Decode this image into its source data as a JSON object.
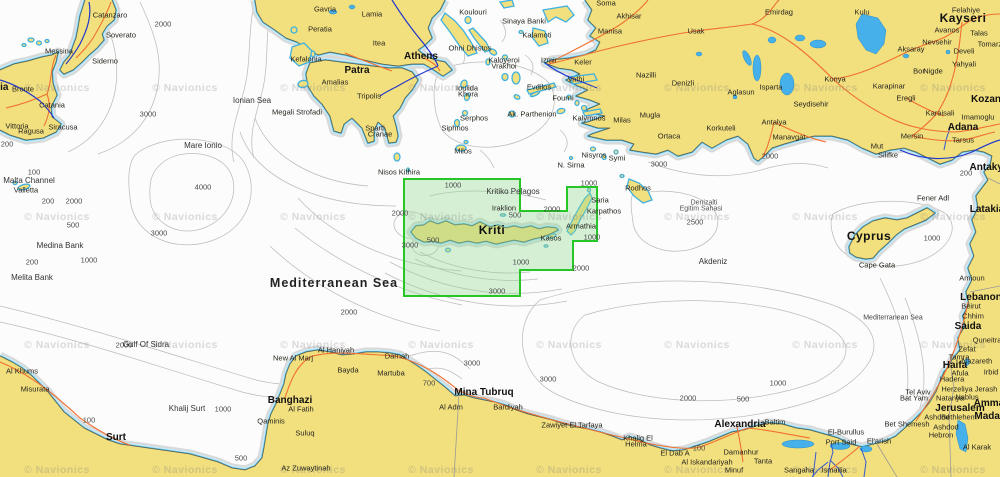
{
  "map": {
    "watermark": "© Navionics",
    "watermark_grid": {
      "cols": [
        57,
        185,
        313,
        441,
        569,
        697,
        825,
        953
      ],
      "rows": [
        88,
        217,
        345,
        470
      ]
    },
    "selection": {
      "points": "404,179 520,179 520,211 567,211 567,187 597,187 597,241 573,241 573,270 520,270 520,296 404,296",
      "stroke": "#25c625",
      "fill": "rgba(150,218,150,0.38)"
    },
    "colors": {
      "land": "#f2df7e",
      "shallow_band": "#c6e9f7",
      "shoreline": "#49b6e4",
      "contour": "#bcbcbc",
      "road": "#f07030",
      "water_route": "#2238cc",
      "lake": "#46b0ea",
      "selection_green": "#25c625"
    },
    "labels": [
      [
        "Catanzaro",
        110,
        15,
        "c"
      ],
      [
        "Soverato",
        121,
        35,
        "c"
      ],
      [
        "Siderno",
        105,
        61,
        "c"
      ],
      [
        "Messina",
        59,
        51,
        "c"
      ],
      [
        "Bronte",
        23,
        89,
        "c"
      ],
      [
        "Catania",
        52,
        105,
        "c"
      ],
      [
        "Vittoria",
        17,
        126,
        "c"
      ],
      [
        "Ragusa",
        31,
        131,
        "c"
      ],
      [
        "Siracusa",
        63,
        127,
        "c"
      ],
      [
        "Sicilia",
        -6,
        88,
        "b"
      ],
      [
        "Malta Channel",
        29,
        181,
        "s"
      ],
      [
        "Valletta",
        26,
        190,
        "c"
      ],
      [
        "Mare Ionio",
        203,
        146,
        "s"
      ],
      [
        "Ionian Sea",
        252,
        101,
        "s"
      ],
      [
        "Medina Bank",
        60,
        246,
        "s"
      ],
      [
        "Melita Bank",
        32,
        278,
        "s"
      ],
      [
        "Gavria",
        325,
        9,
        "c"
      ],
      [
        "Lamia",
        372,
        14,
        "c"
      ],
      [
        "Peratia",
        320,
        29,
        "c"
      ],
      [
        "Itea",
        379,
        43,
        "c"
      ],
      [
        "Athens",
        421,
        57,
        "b"
      ],
      [
        "Patra",
        357,
        71,
        "b"
      ],
      [
        "Kefalonia",
        306,
        59,
        "c"
      ],
      [
        "Amalias",
        335,
        82,
        "c"
      ],
      [
        "Tripolis",
        369,
        96,
        "c"
      ],
      [
        "Sparti",
        375,
        128,
        "c"
      ],
      [
        "Cranae",
        380,
        134,
        "c"
      ],
      [
        "Megali Strofadi",
        297,
        112,
        "c"
      ],
      [
        "Koulouri",
        473,
        12,
        "c"
      ],
      [
        "Sinaya Banki",
        524,
        21,
        "c"
      ],
      [
        "Kalamoti",
        537,
        35,
        "c"
      ],
      [
        "Ohni Dhistos",
        470,
        48,
        "c"
      ],
      [
        "Kaloyeroi",
        504,
        60,
        "c"
      ],
      [
        "Vrakhoi",
        504,
        66,
        "c"
      ],
      [
        "Ioulida",
        467,
        88,
        "c"
      ],
      [
        "Khora",
        468,
        94,
        "c"
      ],
      [
        "Serphos",
        474,
        118,
        "c"
      ],
      [
        "Siphnos",
        455,
        128,
        "c"
      ],
      [
        "Milos",
        463,
        151,
        "c"
      ],
      [
        "Vathi",
        576,
        79,
        "c"
      ],
      [
        "Evdilos",
        539,
        87,
        "c"
      ],
      [
        "Fourni",
        563,
        98,
        "c"
      ],
      [
        "Ak. Parthenion",
        532,
        114,
        "c"
      ],
      [
        "Kalymnos",
        589,
        118,
        "c"
      ],
      [
        "Nisyros",
        594,
        155,
        "c"
      ],
      [
        "Symi",
        617,
        158,
        "c"
      ],
      [
        "Rodhos",
        638,
        188,
        "c"
      ],
      [
        "N. Sirna",
        571,
        165,
        "c"
      ],
      [
        "Nisos Kithira",
        399,
        172,
        "c"
      ],
      [
        "Kritiko Pelagos",
        513,
        192,
        "s"
      ],
      [
        "Iraklion",
        504,
        208,
        "c"
      ],
      [
        "Kriti",
        492,
        230,
        "B"
      ],
      [
        "Saria",
        600,
        200,
        "c"
      ],
      [
        "Karpathos",
        604,
        211,
        "c"
      ],
      [
        "Armathia",
        581,
        226,
        "c"
      ],
      [
        "Kasos",
        551,
        238,
        "c"
      ],
      [
        "Soma",
        606,
        3,
        "c"
      ],
      [
        "Akhisar",
        629,
        16,
        "c"
      ],
      [
        "Manisa",
        610,
        31,
        "c"
      ],
      [
        "Usak",
        696,
        31,
        "c"
      ],
      [
        "Emirdag",
        779,
        12,
        "c"
      ],
      [
        "Izmir",
        549,
        60,
        "c"
      ],
      [
        "Keler",
        583,
        62,
        "c"
      ],
      [
        "Nazilli",
        646,
        75,
        "c"
      ],
      [
        "Denizli",
        683,
        83,
        "c"
      ],
      [
        "Aglasun",
        741,
        92,
        "c"
      ],
      [
        "Isparta",
        771,
        87,
        "c"
      ],
      [
        "Konya",
        835,
        79,
        "c"
      ],
      [
        "Seydisehir",
        811,
        104,
        "c"
      ],
      [
        "Korkuteli",
        721,
        128,
        "c"
      ],
      [
        "Antalya",
        774,
        122,
        "c"
      ],
      [
        "Manavgat",
        789,
        137,
        "c"
      ],
      [
        "Mugla",
        650,
        115,
        "c"
      ],
      [
        "Milas",
        622,
        120,
        "c"
      ],
      [
        "Ortaca",
        669,
        136,
        "c"
      ],
      [
        "Kulu",
        862,
        12,
        "c"
      ],
      [
        "Felahiye",
        966,
        10,
        "c"
      ],
      [
        "Kayseri",
        963,
        18,
        "B"
      ],
      [
        "Avanos",
        947,
        30,
        "c"
      ],
      [
        "Talas",
        979,
        33,
        "c"
      ],
      [
        "Nevsehir",
        937,
        42,
        "c"
      ],
      [
        "Tomarza",
        992,
        44,
        "c"
      ],
      [
        "Develi",
        964,
        51,
        "c"
      ],
      [
        "Yahyali",
        964,
        64,
        "c"
      ],
      [
        "Aksaray",
        911,
        49,
        "c"
      ],
      [
        "Bor",
        919,
        71,
        "c"
      ],
      [
        "Nigde",
        933,
        71,
        "c"
      ],
      [
        "Karapinar",
        889,
        86,
        "c"
      ],
      [
        "Eregli",
        906,
        98,
        "c"
      ],
      [
        "Kozan",
        986,
        100,
        "b"
      ],
      [
        "Karaisali",
        940,
        113,
        "c"
      ],
      [
        "Imamoglu",
        978,
        117,
        "c"
      ],
      [
        "Adana",
        963,
        128,
        "b"
      ],
      [
        "Mersin",
        912,
        136,
        "c"
      ],
      [
        "Tarsus",
        963,
        140,
        "c"
      ],
      [
        "Mut",
        877,
        146,
        "c"
      ],
      [
        "Silifke",
        888,
        155,
        "c"
      ],
      [
        "Denizalti",
        704,
        203,
        "a"
      ],
      [
        "Egitim Sahasi",
        701,
        209,
        "a"
      ],
      [
        "Akdeniz",
        713,
        262,
        "s"
      ],
      [
        "Fener Adl",
        933,
        198,
        "c"
      ],
      [
        "Antakya",
        989,
        168,
        "b"
      ],
      [
        "Latakia",
        987,
        210,
        "b"
      ],
      [
        "Mediterranean Sea",
        893,
        318,
        "S"
      ],
      [
        "Amioun",
        972,
        278,
        "c"
      ],
      [
        "Lebanon",
        981,
        298,
        "b"
      ],
      [
        "Beirut",
        971,
        306,
        "c"
      ],
      [
        "Chhim",
        973,
        316,
        "c"
      ],
      [
        "Saida",
        968,
        327,
        "b"
      ],
      [
        "Quneitra",
        987,
        340,
        "c"
      ],
      [
        "Zefat",
        967,
        349,
        "c"
      ],
      [
        "Tamra",
        959,
        357,
        "c"
      ],
      [
        "Nazareth",
        977,
        361,
        "c"
      ],
      [
        "Haifa",
        955,
        366,
        "b"
      ],
      [
        "Afula",
        960,
        373,
        "c"
      ],
      [
        "Irbid",
        991,
        372,
        "c"
      ],
      [
        "Hadera",
        952,
        379,
        "c"
      ],
      [
        "Herzeliya",
        957,
        389,
        "c"
      ],
      [
        "Jerash",
        986,
        389,
        "c"
      ],
      [
        "Tel Aviv",
        918,
        392,
        "c"
      ],
      [
        "Bat Yam",
        914,
        398,
        "c"
      ],
      [
        "Natanya",
        950,
        398,
        "c"
      ],
      [
        "Nablus",
        967,
        397,
        "c"
      ],
      [
        "Amman",
        992,
        404,
        "b"
      ],
      [
        "Jerusalem",
        960,
        409,
        "b"
      ],
      [
        "Madaba",
        993,
        417,
        "b"
      ],
      [
        "Ashdod",
        937,
        417,
        "c"
      ],
      [
        "Bethlehem",
        959,
        417,
        "c"
      ],
      [
        "Ashdod",
        946,
        427,
        "c"
      ],
      [
        "Bet Shemesh",
        907,
        424,
        "c"
      ],
      [
        "Hebron",
        941,
        435,
        "c"
      ],
      [
        "Al Karak",
        977,
        447,
        "c"
      ],
      [
        "Cyprus",
        869,
        236,
        "B"
      ],
      [
        "Cape Gata",
        877,
        265,
        "c"
      ],
      [
        "Misurata",
        35,
        389,
        "c"
      ],
      [
        "Al Khums",
        22,
        371,
        "c"
      ],
      [
        "Surt",
        116,
        438,
        "b"
      ],
      [
        "Khalij Surt",
        187,
        409,
        "s"
      ],
      [
        "Gulf Of Sidra",
        146,
        345,
        "s"
      ],
      [
        "Qaminis",
        271,
        421,
        "c"
      ],
      [
        "Banghazi",
        290,
        401,
        "b"
      ],
      [
        "Al Fatih",
        301,
        409,
        "c"
      ],
      [
        "Suluq",
        305,
        433,
        "c"
      ],
      [
        "Az Zuwaytinah",
        306,
        468,
        "c"
      ],
      [
        "Bayda",
        348,
        370,
        "c"
      ],
      [
        "Martuba",
        391,
        373,
        "c"
      ],
      [
        "New Al Marj",
        293,
        358,
        "c"
      ],
      [
        "Al Haniyah",
        336,
        350,
        "c"
      ],
      [
        "Darnah",
        397,
        356,
        "c"
      ],
      [
        "Mina Tubruq",
        484,
        393,
        "b"
      ],
      [
        "Al Adm",
        451,
        407,
        "c"
      ],
      [
        "Bardiyah",
        508,
        407,
        "c"
      ],
      [
        "Zawiyet El Tarfaya",
        572,
        425,
        "c"
      ],
      [
        "Khalig El",
        638,
        438,
        "c"
      ],
      [
        "Helma",
        636,
        444,
        "c"
      ],
      [
        "El Dab A",
        675,
        453,
        "c"
      ],
      [
        "Alexandria",
        740,
        425,
        "b"
      ],
      [
        "Al Iskandariyah",
        707,
        462,
        "c"
      ],
      [
        "Damanhur",
        741,
        452,
        "c"
      ],
      [
        "Tanta",
        763,
        461,
        "c"
      ],
      [
        "Minuf",
        734,
        470,
        "c"
      ],
      [
        "Sangaha",
        799,
        470,
        "c"
      ],
      [
        "Ismailia",
        834,
        470,
        "c"
      ],
      [
        "Baltim",
        775,
        422,
        "c"
      ],
      [
        "El-Burullus",
        846,
        432,
        "c"
      ],
      [
        "Port Said",
        841,
        442,
        "c"
      ],
      [
        "El'arish",
        879,
        441,
        "c"
      ],
      [
        "Mediterranean Sea",
        334,
        283,
        "M"
      ],
      [
        "2000",
        163,
        24,
        "d"
      ],
      [
        "3000",
        148,
        114,
        "d"
      ],
      [
        "200",
        7,
        144,
        "d"
      ],
      [
        "100",
        34,
        172,
        "d"
      ],
      [
        "200",
        48,
        201,
        "d"
      ],
      [
        "2000",
        74,
        201,
        "d"
      ],
      [
        "500",
        73,
        225,
        "d"
      ],
      [
        "3000",
        159,
        233,
        "d"
      ],
      [
        "4000",
        203,
        187,
        "d"
      ],
      [
        "1000",
        89,
        260,
        "d"
      ],
      [
        "200",
        32,
        262,
        "d"
      ],
      [
        "2000",
        124,
        345,
        "d"
      ],
      [
        "100",
        89,
        420,
        "d"
      ],
      [
        "500",
        241,
        458,
        "d"
      ],
      [
        "1000",
        223,
        409,
        "d"
      ],
      [
        "700",
        429,
        383,
        "d"
      ],
      [
        "3000",
        472,
        363,
        "d"
      ],
      [
        "3000",
        548,
        379,
        "d"
      ],
      [
        "2000",
        688,
        398,
        "d"
      ],
      [
        "100",
        699,
        448,
        "d"
      ],
      [
        "500",
        743,
        399,
        "d"
      ],
      [
        "1000",
        778,
        383,
        "d"
      ],
      [
        "1000",
        932,
        238,
        "d"
      ],
      [
        "200",
        966,
        173,
        "d"
      ],
      [
        "2000",
        770,
        156,
        "d"
      ],
      [
        "2500",
        695,
        222,
        "d"
      ],
      [
        "3000",
        659,
        164,
        "d"
      ],
      [
        "1000",
        589,
        183,
        "d"
      ],
      [
        "2000",
        552,
        209,
        "d"
      ],
      [
        "2000",
        581,
        268,
        "d"
      ],
      [
        "1000",
        592,
        237,
        "d"
      ],
      [
        "1000",
        453,
        185,
        "d"
      ],
      [
        "2000",
        400,
        213,
        "d"
      ],
      [
        "3000",
        410,
        245,
        "d"
      ],
      [
        "500",
        433,
        240,
        "d"
      ],
      [
        "500",
        515,
        215,
        "d"
      ],
      [
        "1000",
        521,
        262,
        "d"
      ],
      [
        "3000",
        497,
        291,
        "d"
      ],
      [
        "2000",
        349,
        312,
        "d"
      ]
    ]
  }
}
